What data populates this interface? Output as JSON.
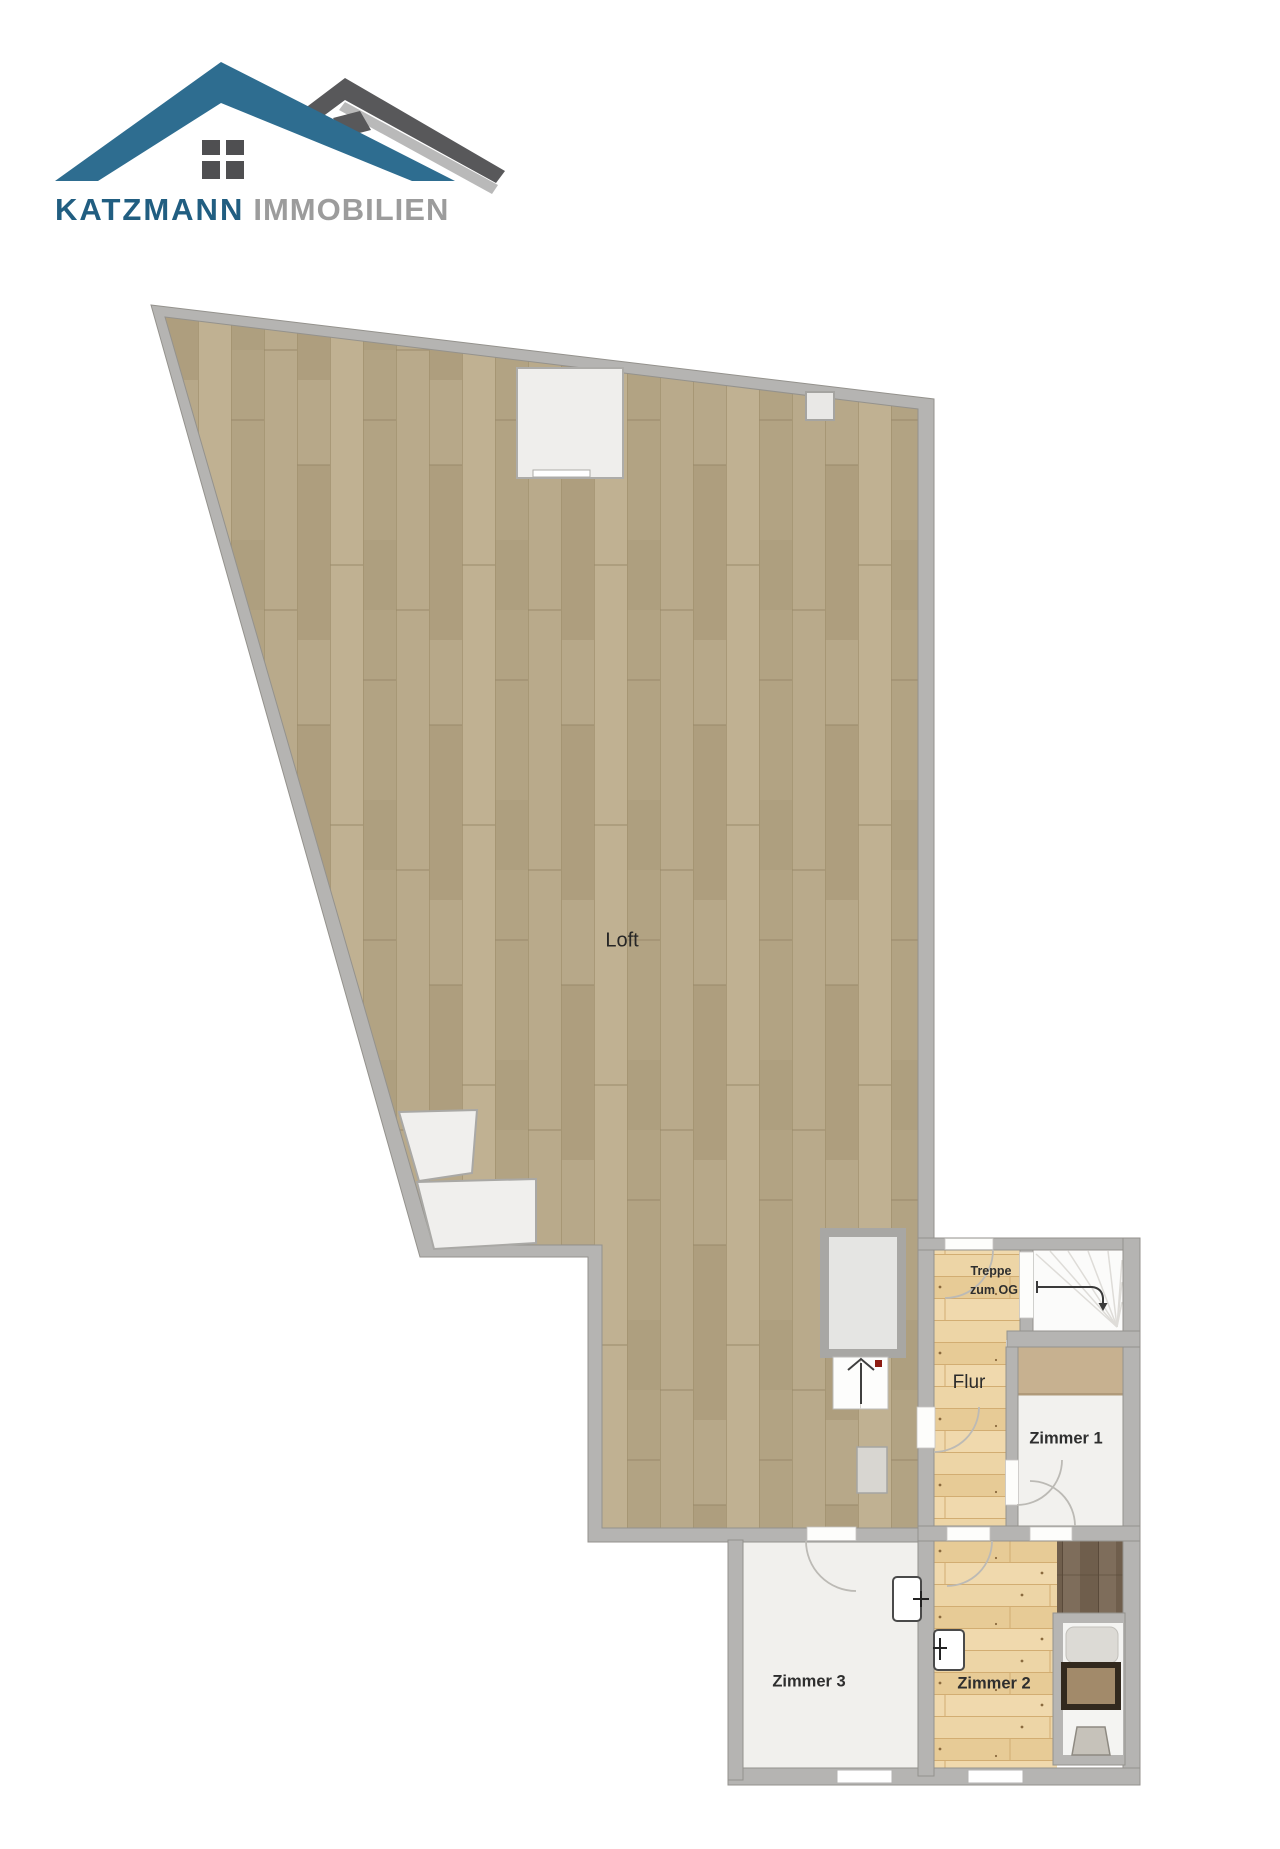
{
  "logo": {
    "brand": "KATZMANN",
    "suffix": "IMMOBILIEN",
    "icon": "two-roofs-house-logo",
    "colors": {
      "roof_blue": "#2e6d90",
      "roof_dark_gray": "#58585a",
      "roof_light_gray": "#b9b9b9",
      "window_dark": "#4f4f51",
      "brand_text_blue": "#215e81",
      "suffix_text_gray": "#9c9c9c"
    }
  },
  "floorplan": {
    "labels": {
      "loft": "Loft",
      "flur": "Flur",
      "treppe_line1": "Treppe",
      "treppe_line2": "zum OG",
      "zimmer1": "Zimmer 1",
      "zimmer2": "Zimmer 2",
      "zimmer3": "Zimmer 3"
    },
    "colors": {
      "wall_gray": "#b5b4b2",
      "wall_edge": "#94928d",
      "loft_parquet": "#b3a384",
      "pine_floor": "#eacf9e",
      "room1_floor": "#f2f1ee",
      "room3_floor": "#f1f0ed",
      "tan_carpet": "#c7b190",
      "dark_brown_floor": "#77664f",
      "stair_room": "#fbfbfa",
      "label_text": "#2e2e2e",
      "direction_red_dot": "#8e1c12"
    }
  }
}
